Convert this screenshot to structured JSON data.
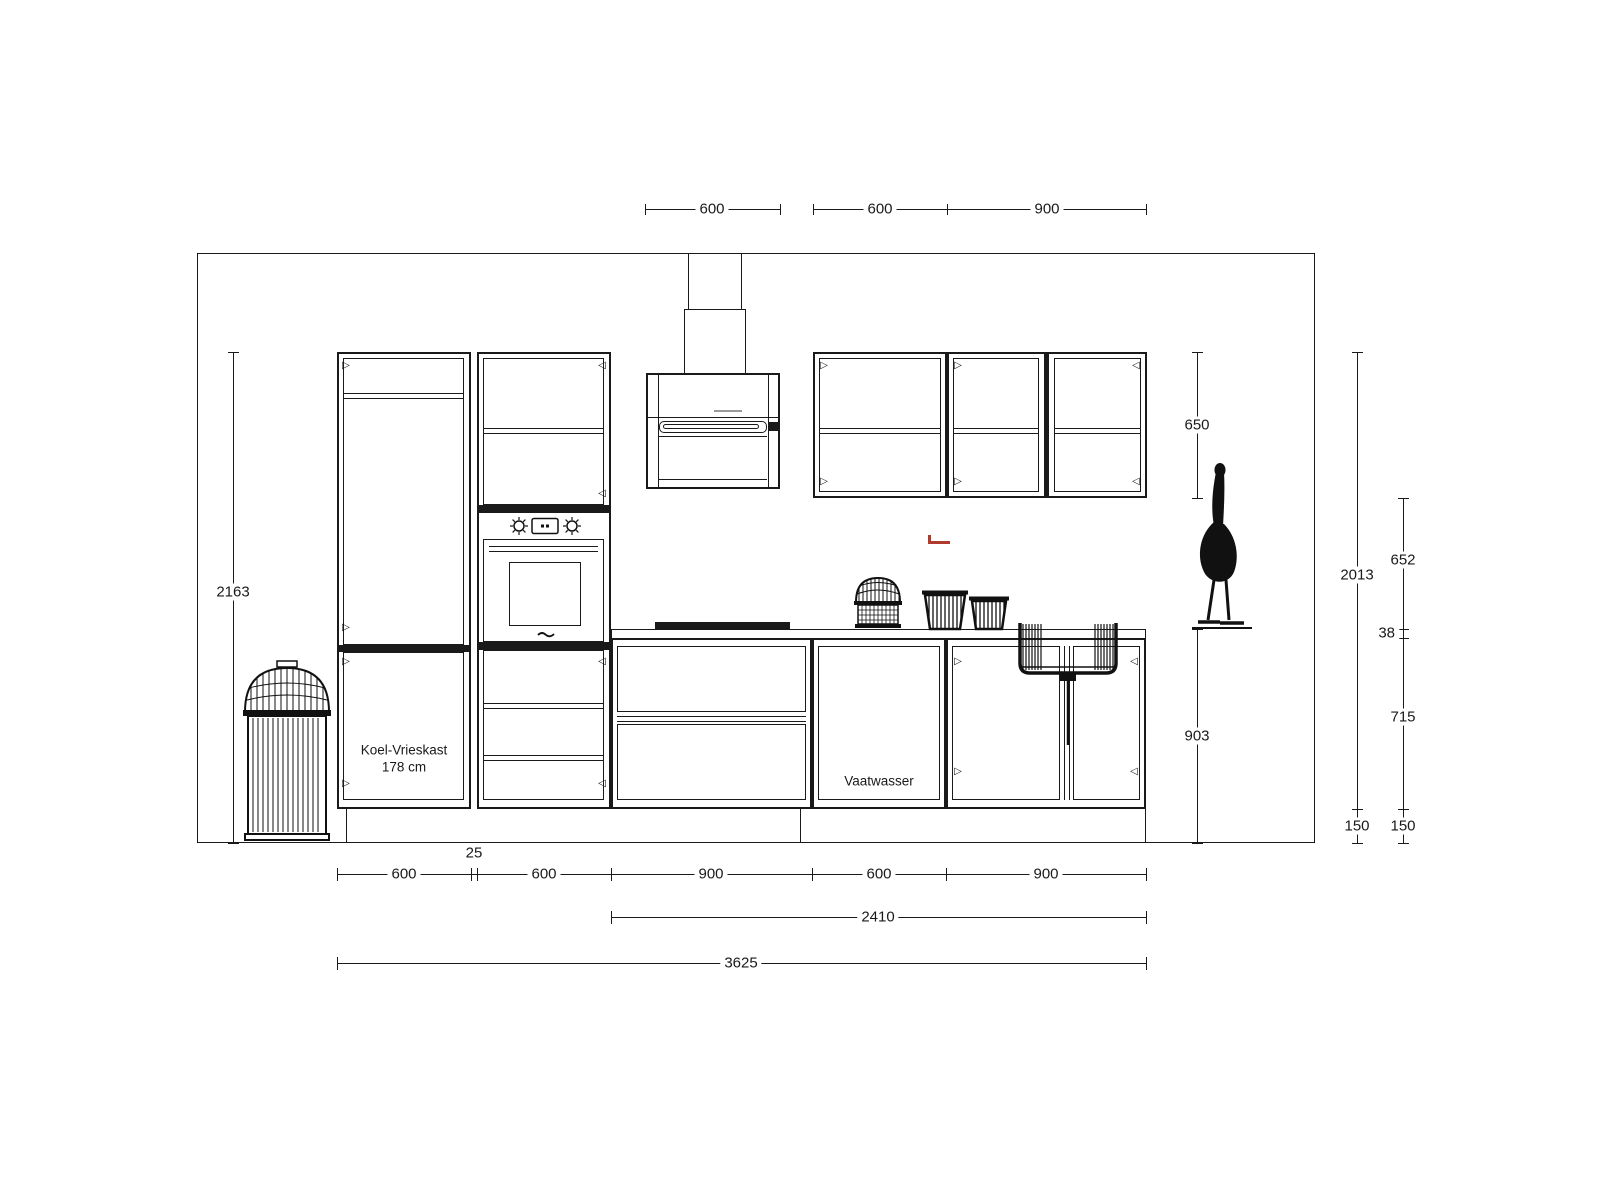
{
  "labels": {
    "fridge_line1": "Koel-Vrieskast",
    "fridge_line2": "178 cm",
    "dishwasher": "Vaatwasser"
  },
  "dims": {
    "top": {
      "hood": "600",
      "wall600": "600",
      "wall900": "900"
    },
    "left": {
      "total_height": "2163"
    },
    "right": {
      "wall_cab_height": "650",
      "worktop_to_floor": "903",
      "units_height": "2013",
      "plinth_a": "150",
      "gap_above_worktop": "652",
      "worktop_thickness": "38",
      "base_cabinet": "715",
      "plinth_b": "150"
    },
    "bottom": {
      "fridge": "600",
      "filler": "25",
      "tower": "600",
      "drawers": "900",
      "dishwasher": "600",
      "sink": "900",
      "run": "2410",
      "total": "3625"
    }
  },
  "icons": {
    "hinge_right": "▷",
    "hinge_left": "◁"
  },
  "colors": {
    "line": "#1a1a1a",
    "accent_red": "#b03a2e",
    "background": "#ffffff"
  }
}
